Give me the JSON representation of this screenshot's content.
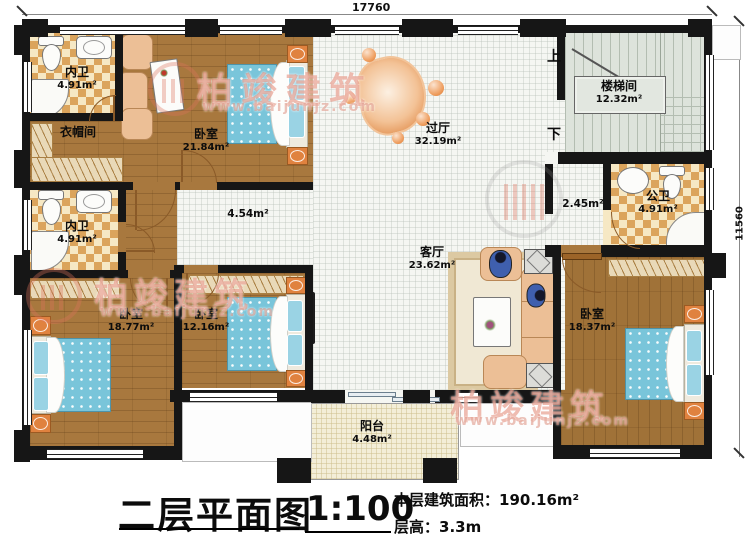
{
  "dims": {
    "top": "17760",
    "right": "11560"
  },
  "rooms": [
    {
      "id": "bath1",
      "name": "内卫",
      "area": "4.91m²"
    },
    {
      "id": "cloak",
      "name": "衣帽间",
      "area": ""
    },
    {
      "id": "bath2",
      "name": "内卫",
      "area": "4.91m²"
    },
    {
      "id": "bed_top",
      "name": "卧室",
      "area": "21.84m²"
    },
    {
      "id": "foyer",
      "name": "过厅",
      "area": "32.19m²"
    },
    {
      "id": "stair",
      "name": "楼梯间",
      "area": "12.32m²"
    },
    {
      "id": "pubbath",
      "name": "公卫",
      "area": "4.91m²"
    },
    {
      "id": "living",
      "name": "客厅",
      "area": "23.62m²"
    },
    {
      "id": "bed_bl",
      "name": "卧室",
      "area": "18.77m²"
    },
    {
      "id": "bed_bm",
      "name": "卧室",
      "area": "12.16m²"
    },
    {
      "id": "bed_br",
      "name": "卧室",
      "area": "18.37m²"
    },
    {
      "id": "balcony",
      "name": "阳台",
      "area": "4.48m²"
    }
  ],
  "open_areas": {
    "hall": "4.54m²",
    "corridor": "2.45m²"
  },
  "stairs": {
    "up": "上",
    "down": "下"
  },
  "watermark": {
    "brand": "柏竣建筑",
    "url": "www.baijunjz.com"
  },
  "titleblock": {
    "title": "二层平面图",
    "scale": "1:100",
    "area_label": "本层建筑面积：",
    "area_value": "190.16m²",
    "height_label": "层高：",
    "height_value": "3.3m"
  },
  "colors": {
    "wall": "#161616",
    "wood_floor": "#a8783e",
    "tile_accent": "#dba45c",
    "bed_blue": "#79c5da",
    "nightstand_orange": "#e0823f",
    "watermark_red": "#dd735c"
  }
}
